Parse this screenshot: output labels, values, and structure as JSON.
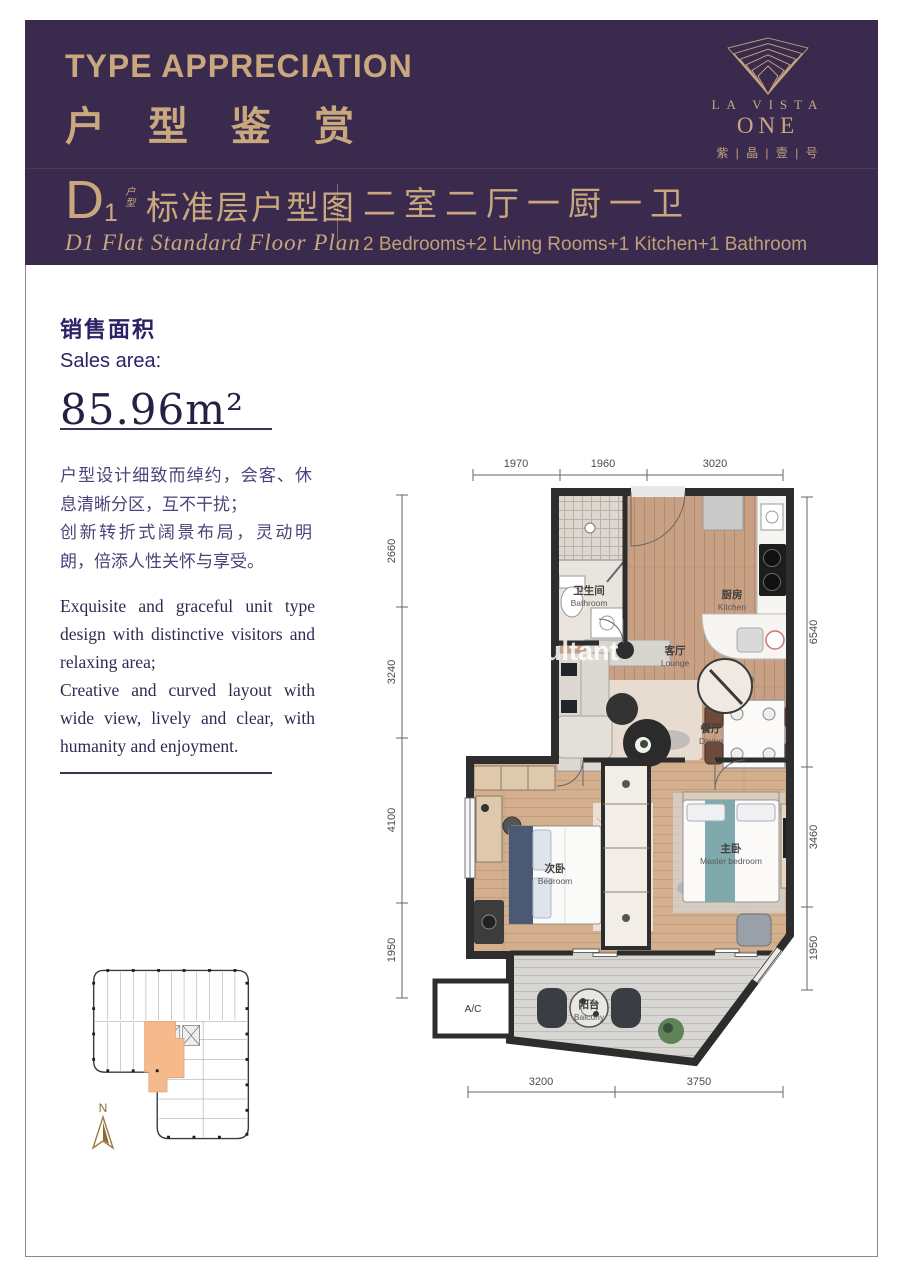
{
  "header": {
    "title_en": "TYPE APPRECIATION",
    "title_zh": "户型鉴赏",
    "logo": {
      "line1": "LA VISTA",
      "line2": "ONE",
      "line3": "紫 | 晶 | 壹 | 号"
    },
    "unit": {
      "code": "D",
      "code_sub": "1",
      "code_tag_top": "户",
      "code_tag_bottom": "型",
      "title_zh": "标准层户型图",
      "title_en": "D1 Flat Standard Floor Plan",
      "layout_zh": "二室二厅一厨一卫",
      "layout_en": "2 Bedrooms+2 Living Rooms+1 Kitchen+1 Bathroom"
    }
  },
  "sales": {
    "label_zh": "销售面积",
    "label_en": "Sales area:",
    "area": "85.96m²"
  },
  "description": {
    "zh1": "户型设计细致而绰约，会客、休息清晰分区，互不干扰；",
    "zh2": "创新转折式阔景布局，灵动明朗，倍添人性关怀与享受。",
    "en1": "Exquisite and graceful unit type design with distinctive visitors and relaxing area;",
    "en2": "Creative and curved layout with wide view, lively and clear, with humanity and enjoyment."
  },
  "floorplan": {
    "dims_top": [
      "1970",
      "1960",
      "3020"
    ],
    "dims_left": [
      "2660",
      "3240",
      "4100",
      "1950"
    ],
    "dims_right": [
      "6540",
      "3460",
      "1950"
    ],
    "dims_bottom": [
      "3200",
      "3750"
    ],
    "rooms": {
      "bathroom": {
        "zh": "卫生间",
        "en": "Bathroom"
      },
      "kitchen": {
        "zh": "厨房",
        "en": "Kitchen"
      },
      "lounge": {
        "zh": "客厅",
        "en": "Lounge"
      },
      "dining": {
        "zh": "餐厅",
        "en": "Dining"
      },
      "bedroom": {
        "zh": "次卧",
        "en": "Bedroom"
      },
      "master": {
        "zh": "主卧",
        "en": "Master bedroom"
      },
      "balcony": {
        "zh": "阳台",
        "en": "Balcony"
      }
    },
    "ac_label": "A/C",
    "watermark": "ultant"
  },
  "keyplan": {
    "north_label": "N"
  },
  "colors": {
    "header_purple": "#3A2A4E",
    "gold": "#C9A87E",
    "ink": "#2C2366",
    "wall": "#2D2D2D",
    "wood": "#C9A183",
    "unit_highlight": "#F2B288",
    "teal_bed": "#7FA9AC"
  }
}
